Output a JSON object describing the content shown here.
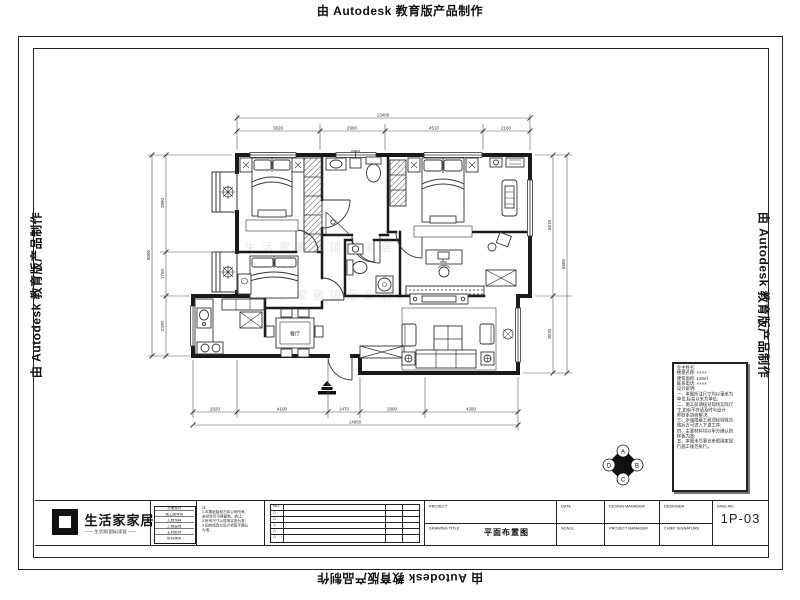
{
  "watermark": {
    "text": "由 Autodesk 教育版产品制作"
  },
  "plan": {
    "room_labels": {
      "dining": "餐厅"
    },
    "brand_watermark": "生活家家居国际家居",
    "dims": {
      "top_total": "13480",
      "top_segments": [
        "3820",
        "2990",
        "4510",
        "2160"
      ],
      "left_total": "8000",
      "left_segments": [
        "3860",
        "1750",
        "2390"
      ],
      "right_total": "8680",
      "right_segments": [
        "5610",
        "3070"
      ],
      "bottom_total": "14950",
      "bottom_segments": [
        "2020",
        "4190",
        "1470",
        "2990",
        "4280"
      ]
    },
    "elevation_marker": {
      "labels": [
        "A",
        "B",
        "C",
        "D"
      ]
    }
  },
  "notes_panel": {
    "lines": [
      "业主姓名:",
      "楼盘名称: ××××",
      "建筑面积: 128㎡",
      "联系电话: ××××",
      "",
      "设计说明:",
      "一、本图所注尺寸均以毫米为",
      "单位,标高以米为单位;",
      "二、施工前请核对现场实际尺",
      "寸,如有不符请及时与设计",
      "师联系协商解决;",
      "三、水电隐蔽工程须经验收合",
      "格后方可进入下道工序;",
      "四、主要材料均以甲方确认的",
      "样板为准;",
      "五、本图未尽事宜参照国家现",
      "行施工规范执行。"
    ]
  },
  "title_block": {
    "logo": {
      "name": "生活家家居",
      "tagline": "—— 生活家(国际)家居 ——"
    },
    "services": [
      "方案设计",
      "施工图深化",
      "工程预算",
      "工程监理",
      "主材配饰",
      "售后服务"
    ],
    "notes": [
      "注:",
      "1.本图纸版权归本公司所有,",
      "未经许可不得复制、转让;",
      "2.所有尺寸以现场实测为准;",
      "3.如有修改以设计师签字确认",
      "为准。"
    ],
    "revisions": {
      "header_no": "NO.",
      "symbol": "△"
    },
    "project": {
      "label": "PROJECT",
      "drawing_title_label": "DRAWING TITLE",
      "drawing_title": "平面布置图"
    },
    "fields": {
      "date": "DATE",
      "scale": "SCALE",
      "design_manager": "DESIGN MANAGER",
      "project_manager": "PROJECT MANAGER",
      "designer": "DESIGNER",
      "chief_signature": "CHIEF SIGNATURE",
      "dwg_no_label": "DWG NO.",
      "dwg_no": "1P-03"
    }
  }
}
